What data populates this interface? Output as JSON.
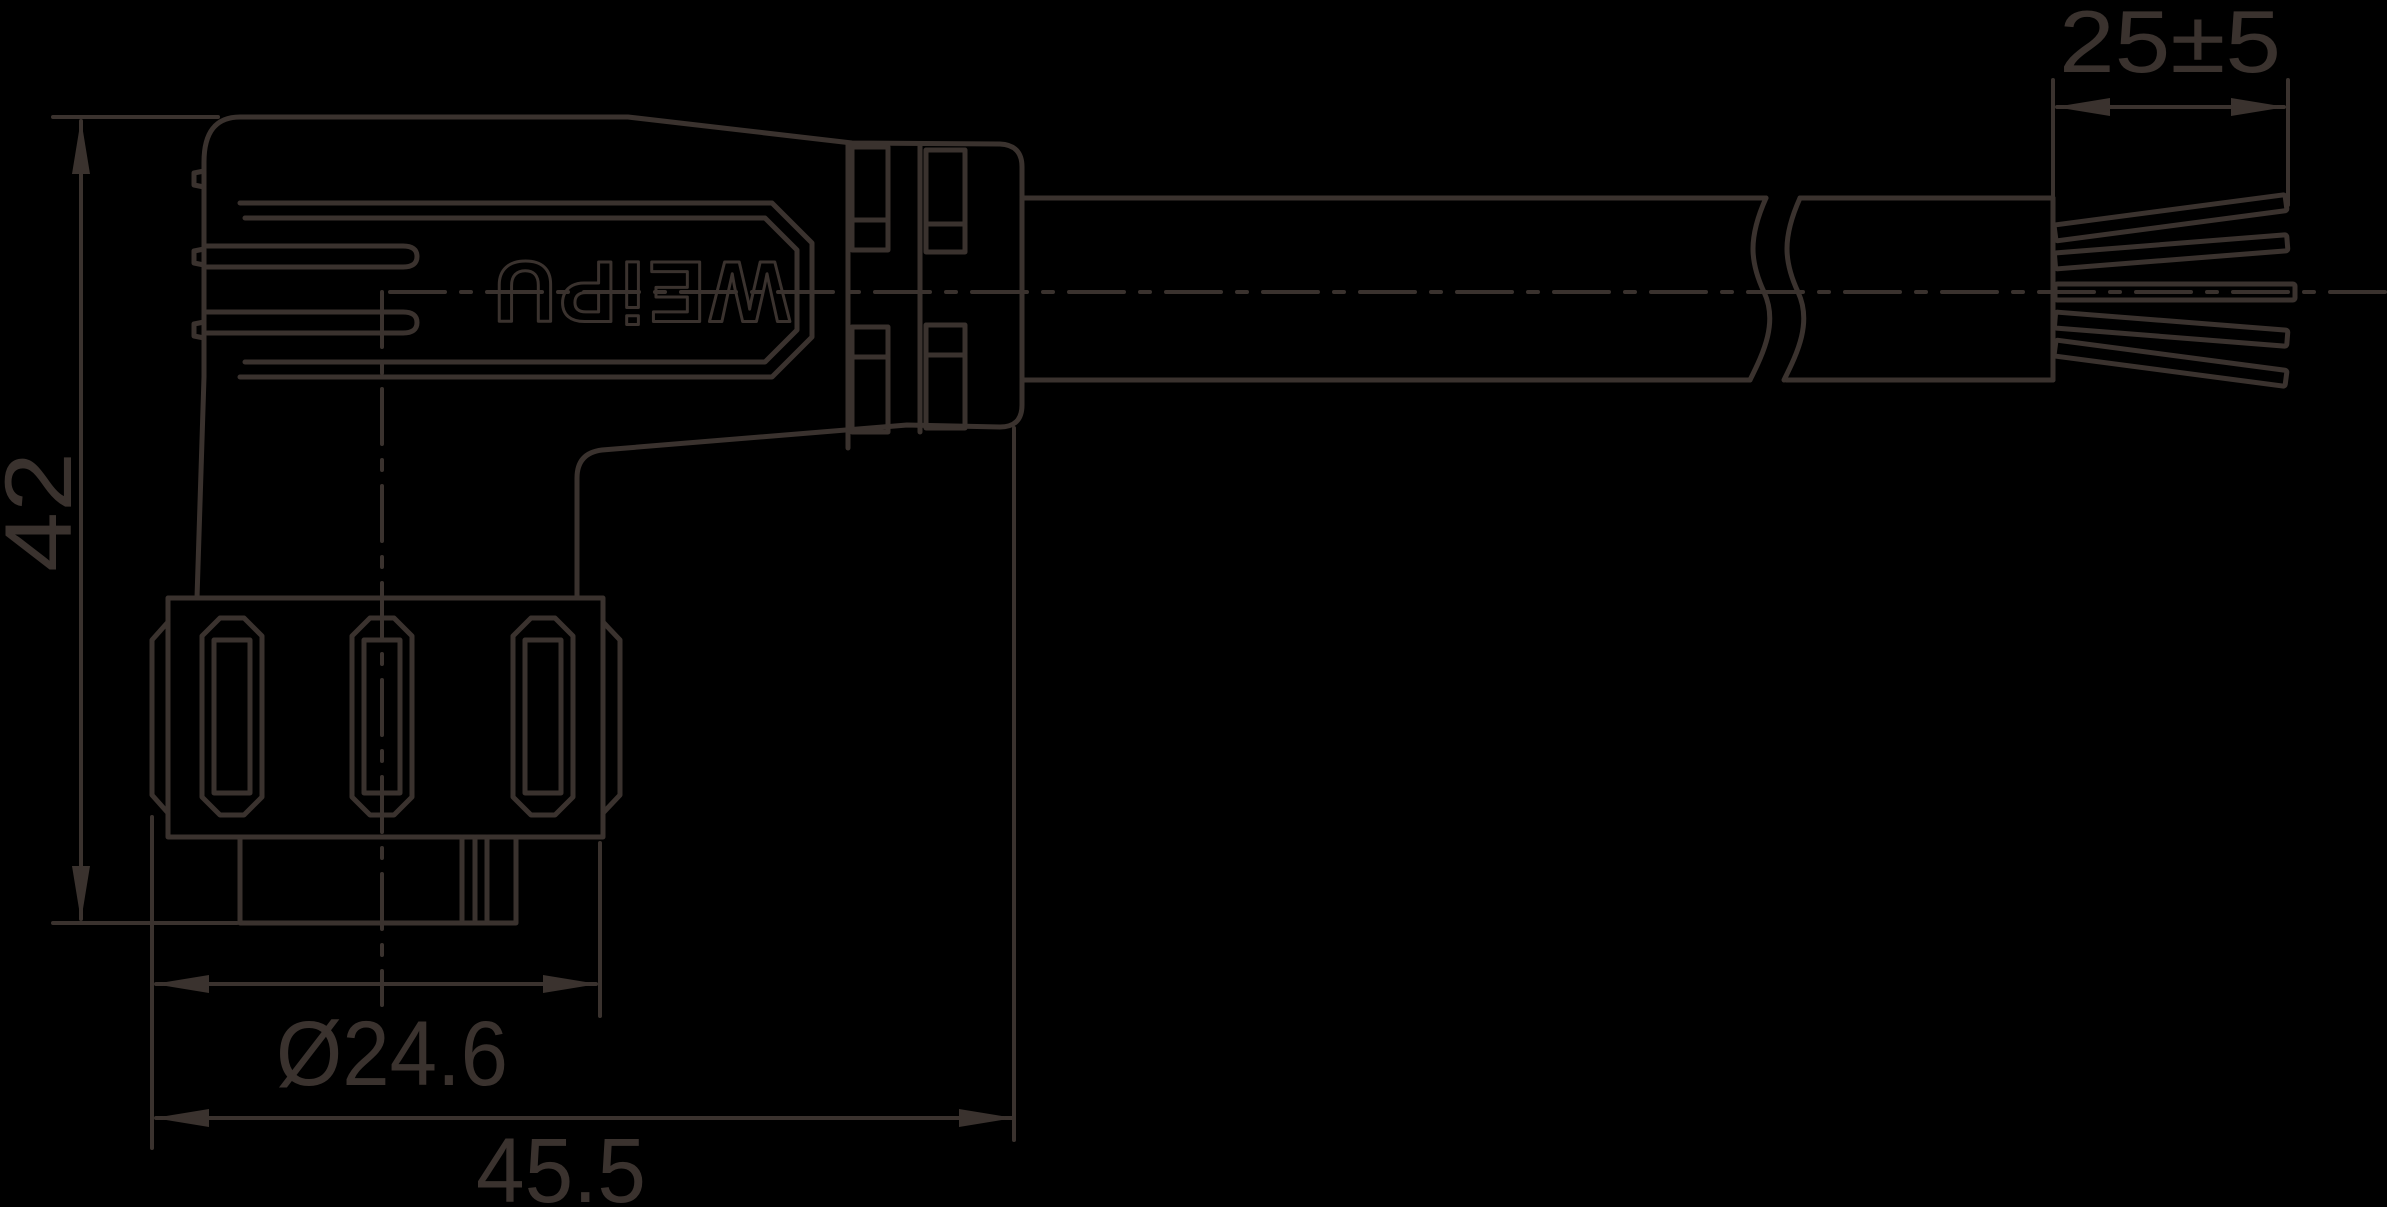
{
  "canvas": {
    "background": "#000000",
    "line_color": "#3a322e"
  },
  "logo": {
    "text": "WEiPU"
  },
  "dimensions": {
    "strip_length": {
      "label": "25±5"
    },
    "height": {
      "label": "42"
    },
    "nut_diameter": {
      "label": "Ø24.6"
    },
    "body_length": {
      "label": "45.5"
    }
  }
}
